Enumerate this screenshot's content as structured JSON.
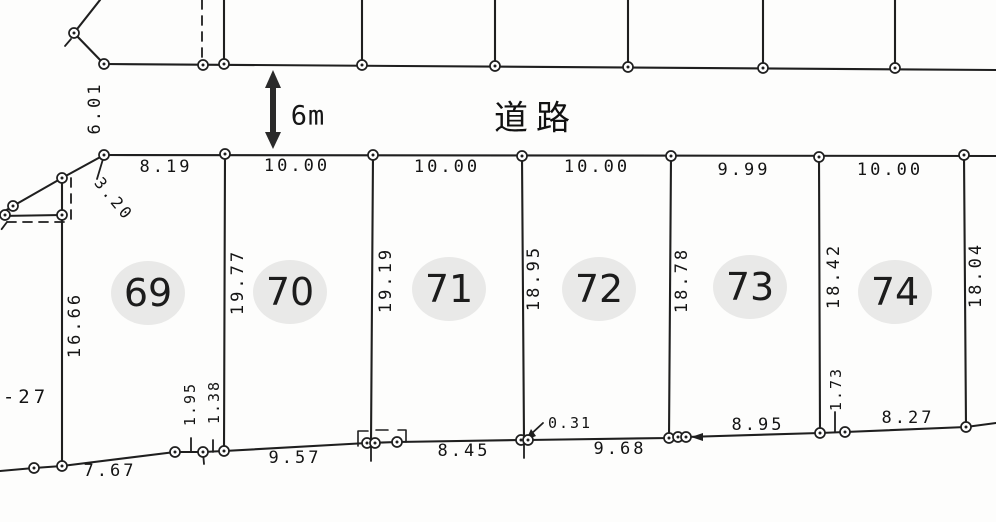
{
  "road": {
    "label": "道路",
    "width": "6m",
    "side_dim": "6.01"
  },
  "plots": [
    {
      "number": "69"
    },
    {
      "number": "70"
    },
    {
      "number": "71"
    },
    {
      "number": "72"
    },
    {
      "number": "73"
    },
    {
      "number": "74"
    }
  ],
  "dims": {
    "frontage": [
      "8.19",
      "10.00",
      "10.00",
      "10.00",
      "9.99",
      "10.00"
    ],
    "depth": [
      "16.66",
      "19.77",
      "19.19",
      "18.95",
      "18.78",
      "18.42",
      "18.04"
    ],
    "rear": [
      "7.67",
      "9.57",
      "8.45",
      "9.68",
      "8.95",
      "8.27"
    ],
    "diagonal": "3.20",
    "offsets": [
      "1.95",
      "1.38",
      "0.31",
      "1.73"
    ],
    "edge_label": "-27"
  }
}
